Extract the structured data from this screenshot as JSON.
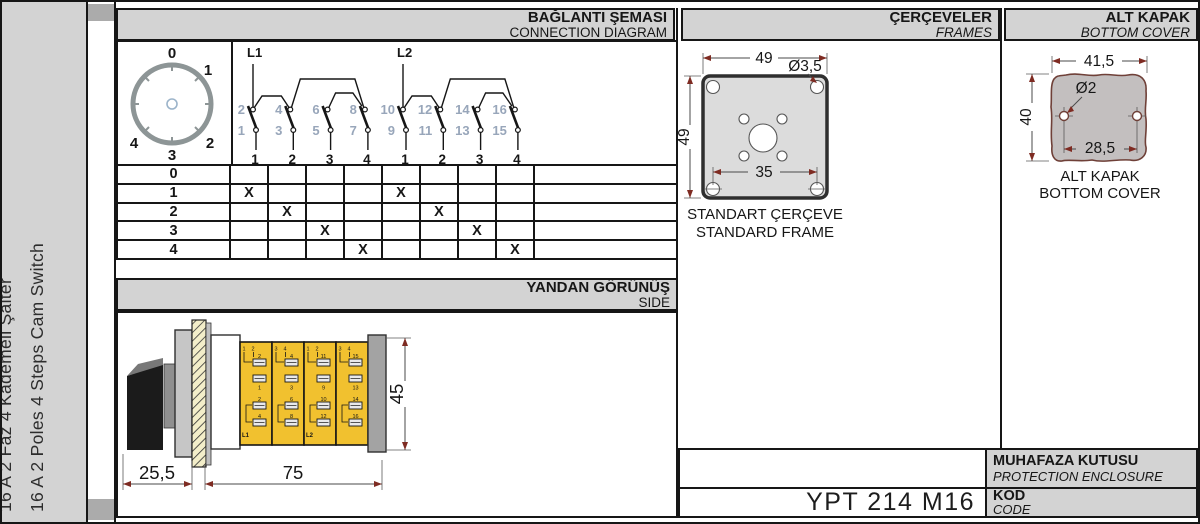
{
  "colors": {
    "panel_gray": "#d3d3d3",
    "spine_gray": "#ababab",
    "line": "#161616",
    "module_yellow": "#f1c12f",
    "hatch_bg": "#f3eec9",
    "arrow_red": "#7e2b22",
    "terminal_blue": "#98a6ba",
    "frame_fill": "#dcdcdc",
    "cover_fill": "#c3bfbf",
    "cover_outline": "#6f4038"
  },
  "sidebar": {
    "title_tr": "16 A 2 Faz 4 Kademeli Şalter",
    "title_en": "16 A 2 Poles 4 Steps Cam Switch"
  },
  "headers": {
    "connection_tr": "BAĞLANTI ŞEMASI",
    "connection_en": "CONNECTION DIAGRAM",
    "frames_tr": "ÇERÇEVELER",
    "frames_en": "FRAMES",
    "cover_tr": "ALT KAPAK",
    "cover_en": "BOTTOM COVER",
    "side_tr": "YANDAN GÖRÜNÜŞ",
    "side_en": "SIDE"
  },
  "dial": {
    "labels": [
      "0",
      "1",
      "2",
      "3",
      "4"
    ]
  },
  "connection": {
    "groups": [
      {
        "label": "L1",
        "top": [
          "2",
          "4",
          "6",
          "8"
        ],
        "bottom": [
          "1",
          "3",
          "5",
          "7"
        ],
        "columns": [
          "1",
          "2",
          "3",
          "4"
        ]
      },
      {
        "label": "L2",
        "top": [
          "10",
          "12",
          "14",
          "16"
        ],
        "bottom": [
          "9",
          "11",
          "13",
          "15"
        ],
        "columns": [
          "1",
          "2",
          "3",
          "4"
        ]
      }
    ]
  },
  "step_table": {
    "mark": "X",
    "rows": [
      {
        "label": "0",
        "marks": []
      },
      {
        "label": "1",
        "marks": [
          1,
          5
        ]
      },
      {
        "label": "2",
        "marks": [
          2,
          6
        ]
      },
      {
        "label": "3",
        "marks": [
          3,
          7
        ]
      },
      {
        "label": "4",
        "marks": [
          4,
          8
        ]
      }
    ]
  },
  "side_view": {
    "dims": {
      "knob": "25,5",
      "body": "75",
      "height": "45"
    },
    "modules": [
      {
        "corner": [
          "1",
          "2"
        ],
        "upper": [
          "2",
          "1"
        ],
        "lower": [
          "2",
          "4"
        ],
        "line": "L1"
      },
      {
        "corner": [
          "3",
          "4"
        ],
        "upper": [
          "4",
          "3"
        ],
        "lower": [
          "6",
          "8"
        ],
        "line": ""
      },
      {
        "corner": [
          "1",
          "2"
        ],
        "upper": [
          "11",
          "9"
        ],
        "lower": [
          "10",
          "12"
        ],
        "line": "L2"
      },
      {
        "corner": [
          "3",
          "4"
        ],
        "upper": [
          "15",
          "13"
        ],
        "lower": [
          "14",
          "16"
        ],
        "line": ""
      }
    ]
  },
  "frames": {
    "dims": {
      "width": "49",
      "height": "49",
      "hole": "Ø3,5",
      "inner": "35"
    },
    "caption_tr": "STANDART ÇERÇEVE",
    "caption_en": "STANDARD FRAME"
  },
  "cover": {
    "dims": {
      "width": "41,5",
      "height": "40",
      "hole": "Ø2",
      "holes_span": "28,5"
    },
    "caption_tr": "ALT KAPAK",
    "caption_en": "BOTTOM COVER"
  },
  "footer": {
    "enclosure_tr": "MUHAFAZA KUTUSU",
    "enclosure_en": "PROTECTION ENCLOSURE",
    "code_tr": "KOD",
    "code_en": "CODE",
    "code_value": "YPT 214 M16"
  }
}
